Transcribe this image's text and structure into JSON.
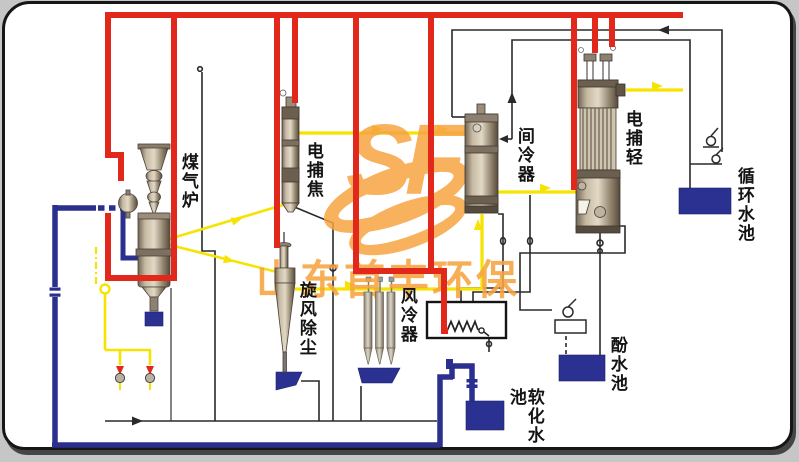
{
  "watermark": {
    "logo": "SF",
    "text": "山东首丰环保"
  },
  "labels": {
    "gas_furnace": "煤气炉",
    "electric_tar_catcher": "电捕焦",
    "intercooler": "间冷器",
    "electric_light_tar_catcher": "电捕轻",
    "circulating_water_pool": "循环水池",
    "cyclone_dust_removal": "旋风除尘",
    "air_cooler": "风冷器",
    "phenol_water_pool": "酚水池",
    "softened_water_pool": "软化水池"
  },
  "colors": {
    "red_pipe": "#e2281b",
    "yellow_pipe": "#f6e300",
    "blue_pipe": "#2b2f8e",
    "pool": "#2b3190",
    "watermark": "#f7a440",
    "thin_line": "#2a2a2a"
  }
}
